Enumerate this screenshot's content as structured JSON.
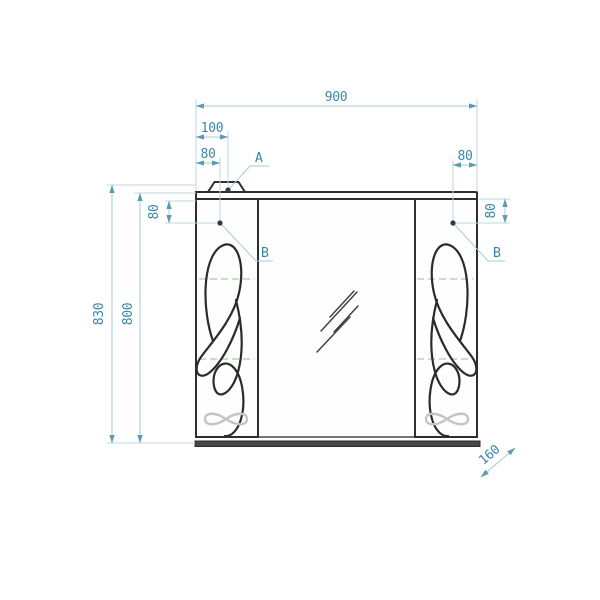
{
  "dimensions": {
    "overall_width": "900",
    "lamp_offset_from_left": "100",
    "hinge_inset_left": "80",
    "hinge_inset_right": "80",
    "hinge_drop_left": "80",
    "hinge_drop_right": "80",
    "overall_height": "830",
    "body_height": "800",
    "depth": "160"
  },
  "callouts": {
    "lamp": "A",
    "hinge_left": "B",
    "hinge_right": "B"
  },
  "colors": {
    "dimension_text": "#3a87a8",
    "dimension_line": "#a5cbdb",
    "extension_line": "#bcd8e4",
    "arrowhead": "#5d9ab6",
    "cabinet_outline": "#2e2e2e",
    "shelf_centerline_green": "#b2d8ac",
    "handle_gray": "#c4c4c4"
  }
}
